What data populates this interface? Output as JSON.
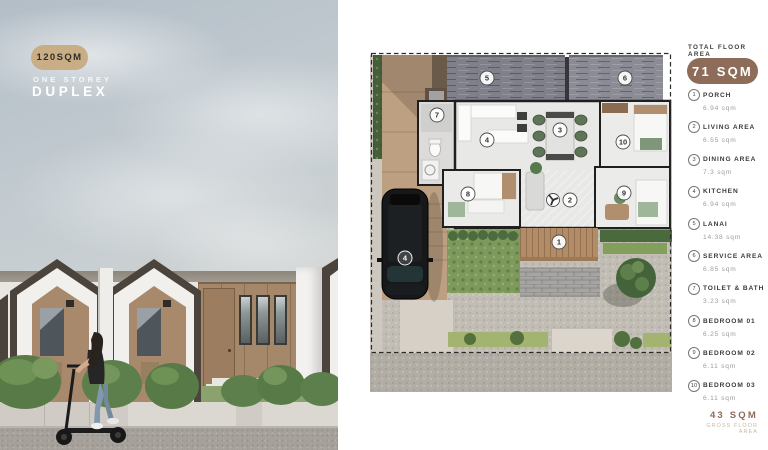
{
  "badge": {
    "pill": "120SQM",
    "subtitle": "ONE STOREY",
    "title": "DUPLEX"
  },
  "legend": {
    "header": "TOTAL FLOOR AREA",
    "total": "71 SQM",
    "items": [
      {
        "num": "1",
        "label": "PORCH",
        "area": "6.94 sqm"
      },
      {
        "num": "2",
        "label": "LIVING AREA",
        "area": "6.55 sqm"
      },
      {
        "num": "3",
        "label": "DINING AREA",
        "area": "7.3 sqm"
      },
      {
        "num": "4",
        "label": "KITCHEN",
        "area": "6.94 sqm"
      },
      {
        "num": "5",
        "label": "LANAI",
        "area": "14.38 sqm"
      },
      {
        "num": "6",
        "label": "SERVICE AREA",
        "area": "6.85 sqm"
      },
      {
        "num": "7",
        "label": "TOILET & BATH",
        "area": "3.23 sqm"
      },
      {
        "num": "8",
        "label": "BEDROOM 01",
        "area": "6.25 sqm"
      },
      {
        "num": "9",
        "label": "BEDROOM 02",
        "area": "6.11 sqm"
      },
      {
        "num": "10",
        "label": "BEDROOM 03",
        "area": "6.11 sqm"
      }
    ],
    "gross_value": "43 SQM",
    "gross_label": "GROSS FLOOR AREA"
  },
  "plan": {
    "markers": {
      "porch": "1",
      "living": "2",
      "dining": "3",
      "kitchen": "4",
      "lanai": "5",
      "service": "6",
      "toilet": "7",
      "bedroom1": "8",
      "bedroom2": "9",
      "bedroom3": "10",
      "carport": "4"
    }
  },
  "colors": {
    "badge_pill": "#c9ae85",
    "total_pill": "#8d6c59",
    "gross_text": "#8d6c59"
  }
}
